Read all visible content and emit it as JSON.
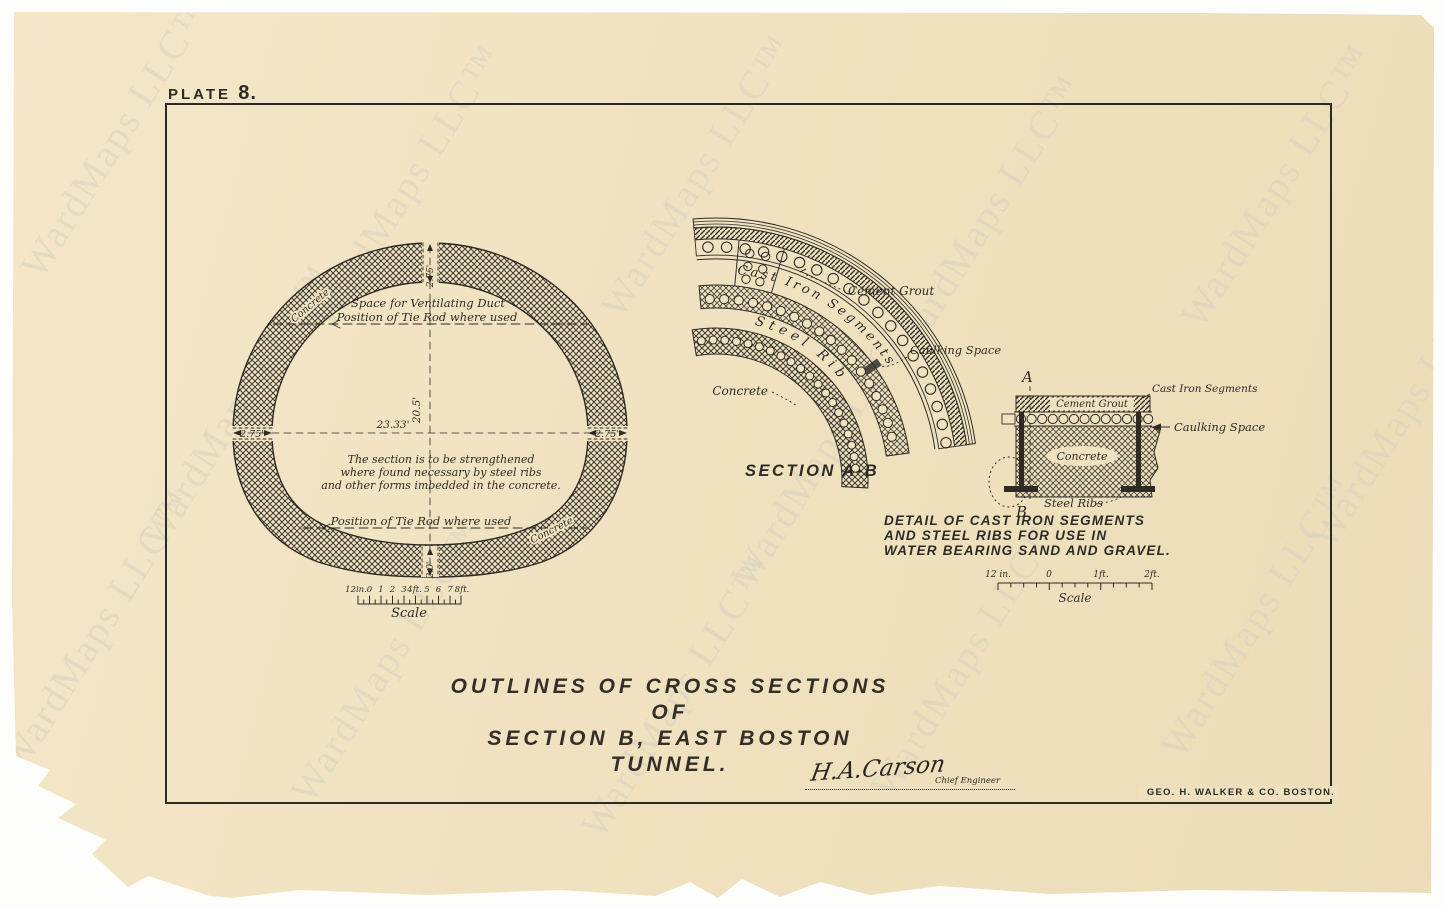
{
  "watermark_text": "WardMaps LLC™",
  "plate": {
    "word": "PLATE",
    "number": "8."
  },
  "cross_section": {
    "dim_crown_thickness": "2.75'",
    "dim_springline_left": "2.75'",
    "dim_springline_right": "2.75'",
    "dim_inner_height": "20.5'",
    "dim_inner_width": "23.33'",
    "dim_invert_thickness": "2.0'",
    "label_vent_duct": "Space for Ventilating Duct",
    "label_tie_rod_upper": "Position of Tie Rod where used",
    "label_tie_rod_lower": "Position of Tie Rod where used",
    "label_concrete_upper_left": "Concrete",
    "label_concrete_lower_right": "Concrete",
    "note_lines": [
      "The section is to be strengthened",
      "where found necessary by steel ribs",
      "and other forms imbedded in the concrete."
    ],
    "scale_ticks": [
      "12in.",
      "0",
      "1",
      "2",
      "3",
      "4ft.",
      "5",
      "6",
      "7",
      "8ft."
    ],
    "scale_label": "Scale"
  },
  "section_ab": {
    "title": "SECTION A-B",
    "label_cement_grout": "Cement Grout",
    "label_caulking_space": "Caulking Space",
    "label_cast_iron_segments": "Cast Iron Segments",
    "label_steel_rib": "Steel Rib",
    "label_concrete": "Concrete"
  },
  "detail": {
    "marker_top": "A",
    "marker_bottom": "B",
    "label_cast_iron_segments": "Cast Iron Segments",
    "label_cement_grout": "Cement Grout",
    "label_caulking_space": "Caulking Space",
    "label_concrete": "Concrete",
    "label_steel_ribs": "Steel Ribs",
    "title_lines": [
      "DETAIL OF CAST IRON SEGMENTS",
      "AND STEEL RIBS FOR USE IN",
      "WATER BEARING SAND AND GRAVEL."
    ],
    "scale_ticks": [
      "12 in.",
      "0",
      "1ft.",
      "2ft."
    ],
    "scale_label": "Scale"
  },
  "title_block": {
    "line1": "OUTLINES OF CROSS SECTIONS OF",
    "line2": "SECTION B, EAST BOSTON TUNNEL."
  },
  "signature": {
    "name": "H.A.Carson",
    "role": "Chief Engineer"
  },
  "printer_credit": "GEO. H. WALKER & CO. BOSTON."
}
